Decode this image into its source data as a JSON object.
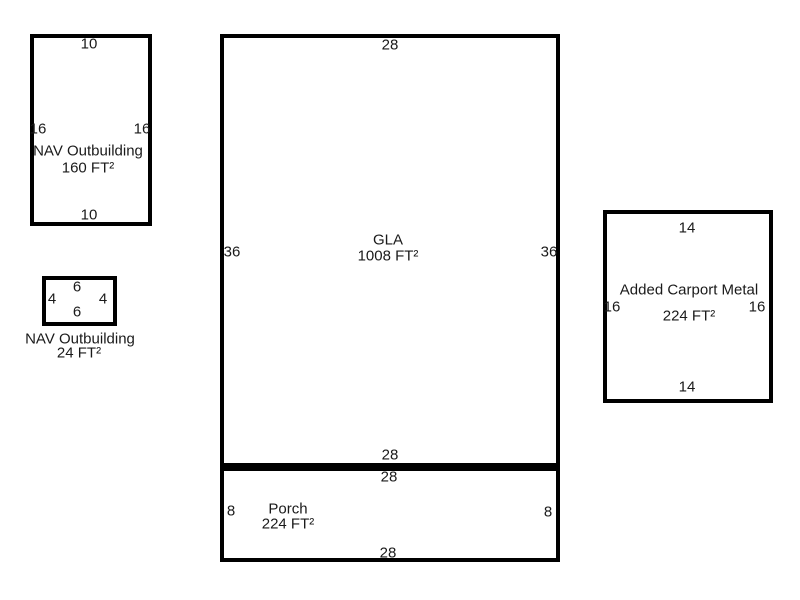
{
  "sketch": {
    "background_color": "#ffffff",
    "line_color": "#000000",
    "text_color": "#1a1a1a",
    "unit_suffix": "FT²",
    "buildings": [
      {
        "name": "NAV Outbuilding",
        "area": "160 FT²",
        "dims": {
          "top": "10",
          "bottom": "10",
          "left": "16",
          "right": "16"
        }
      },
      {
        "name": "NAV Outbuilding",
        "area": "24 FT²",
        "dims": {
          "top": "6",
          "bottom": "6",
          "left": "4",
          "right": "4"
        }
      },
      {
        "name": "GLA",
        "area": "1008 FT²",
        "dims": {
          "top": "28",
          "bottom": "28",
          "left": "36",
          "right": "36"
        }
      },
      {
        "name": "Porch",
        "area": "224 FT²",
        "dims": {
          "top": "28",
          "bottom": "28",
          "left": "8",
          "right": "8"
        }
      },
      {
        "name": "Added Carport Metal",
        "area": "224 FT²",
        "dims": {
          "top": "14",
          "bottom": "14",
          "left": "16",
          "right": "16"
        }
      }
    ]
  }
}
